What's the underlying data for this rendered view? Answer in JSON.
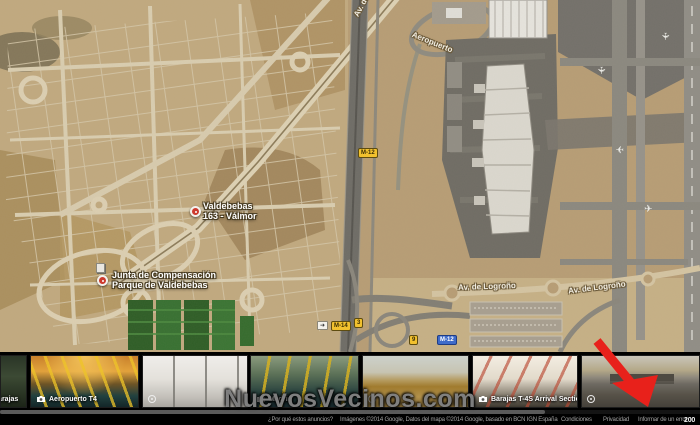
{
  "map": {
    "markers": [
      {
        "line1": "Valdebebas",
        "line2": "163 - Válmor"
      },
      {
        "line1": "Junta de Compensación",
        "line2": "Parque de Valdebebas"
      }
    ],
    "street_labels": [
      {
        "text": "Av. de la Hispanidad"
      },
      {
        "text": "Aeropuerto"
      },
      {
        "text": "Av. de Logroño"
      },
      {
        "text": "Av. de Logroño"
      }
    ],
    "road_shields": [
      {
        "text": "M-12"
      },
      {
        "text": "M-14"
      },
      {
        "text": "3"
      },
      {
        "text": "9"
      },
      {
        "text": "M-12"
      }
    ]
  },
  "photo_strip": {
    "items": [
      {
        "label": "Barajas",
        "icon": "camera-icon"
      },
      {
        "label": "Aeropuerto T4",
        "icon": "camera-icon"
      },
      {
        "label": "",
        "icon": "streetview-icon"
      },
      {
        "label": "Madrid",
        "icon": "camera-icon"
      },
      {
        "label": "",
        "icon": "streetview-icon"
      },
      {
        "label": "Barajas T-4S Arrival Section",
        "icon": "camera-icon"
      },
      {
        "label": "",
        "icon": "streetview-icon"
      }
    ]
  },
  "watermark": "NuevosVecinos.com",
  "footer": {
    "ads_link": "¿Por qué estos anuncios?",
    "attribution": "Imágenes ©2014 Google, Datos del mapa ©2014 Google, basado en BCN IGN España",
    "link_terms": "Condiciones",
    "link_privacy": "Privacidad",
    "link_report": "Informar de un error",
    "scale_text": "200"
  },
  "colors": {
    "annotation_arrow_red": "#e8211b",
    "shield_yellow": "#f2c12e",
    "shield_blue": "#3f6bc9",
    "marker_red": "#cc3a2e",
    "terrain_tan": "#b79d75"
  }
}
